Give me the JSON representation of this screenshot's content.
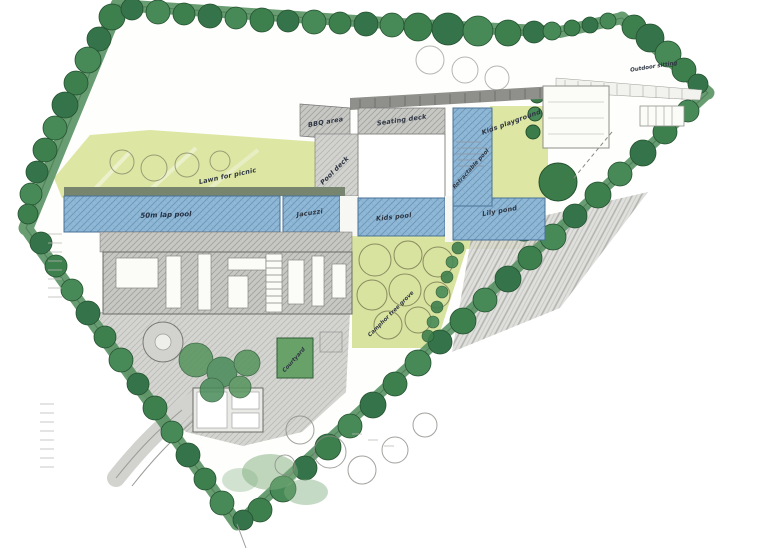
{
  "plan": {
    "title": "Hand-drawn landscape site plan sketch",
    "labels": {
      "bbq_area": "BBQ area",
      "seating_deck": "Seating deck",
      "kids_playground": "Kids playground",
      "pool_deck": "Pool deck",
      "lawn_for_picnic": "Lawn for picnic",
      "lap_pool": "50m lap pool",
      "jacuzzi": "Jacuzzi",
      "kids_pool": "Kids pool",
      "lily_pond": "Lily pond",
      "retractable_pool": "Retractable pool",
      "camphor_grove": "Camphor tree grove",
      "courtyard": "Courtyard",
      "outdoor_sitting": "Outdoor sitting"
    },
    "colors": {
      "tree_green": "#3e7f4e",
      "hedge_green": "#4e8c5a",
      "lawn_lime": "#dde6a3",
      "pool_blue": "#8fb7d6",
      "roof_gray": "#c7c7c4",
      "pencil_gray": "#9b9b98",
      "ink": "#2e3642",
      "paper": "#ffffff"
    }
  }
}
